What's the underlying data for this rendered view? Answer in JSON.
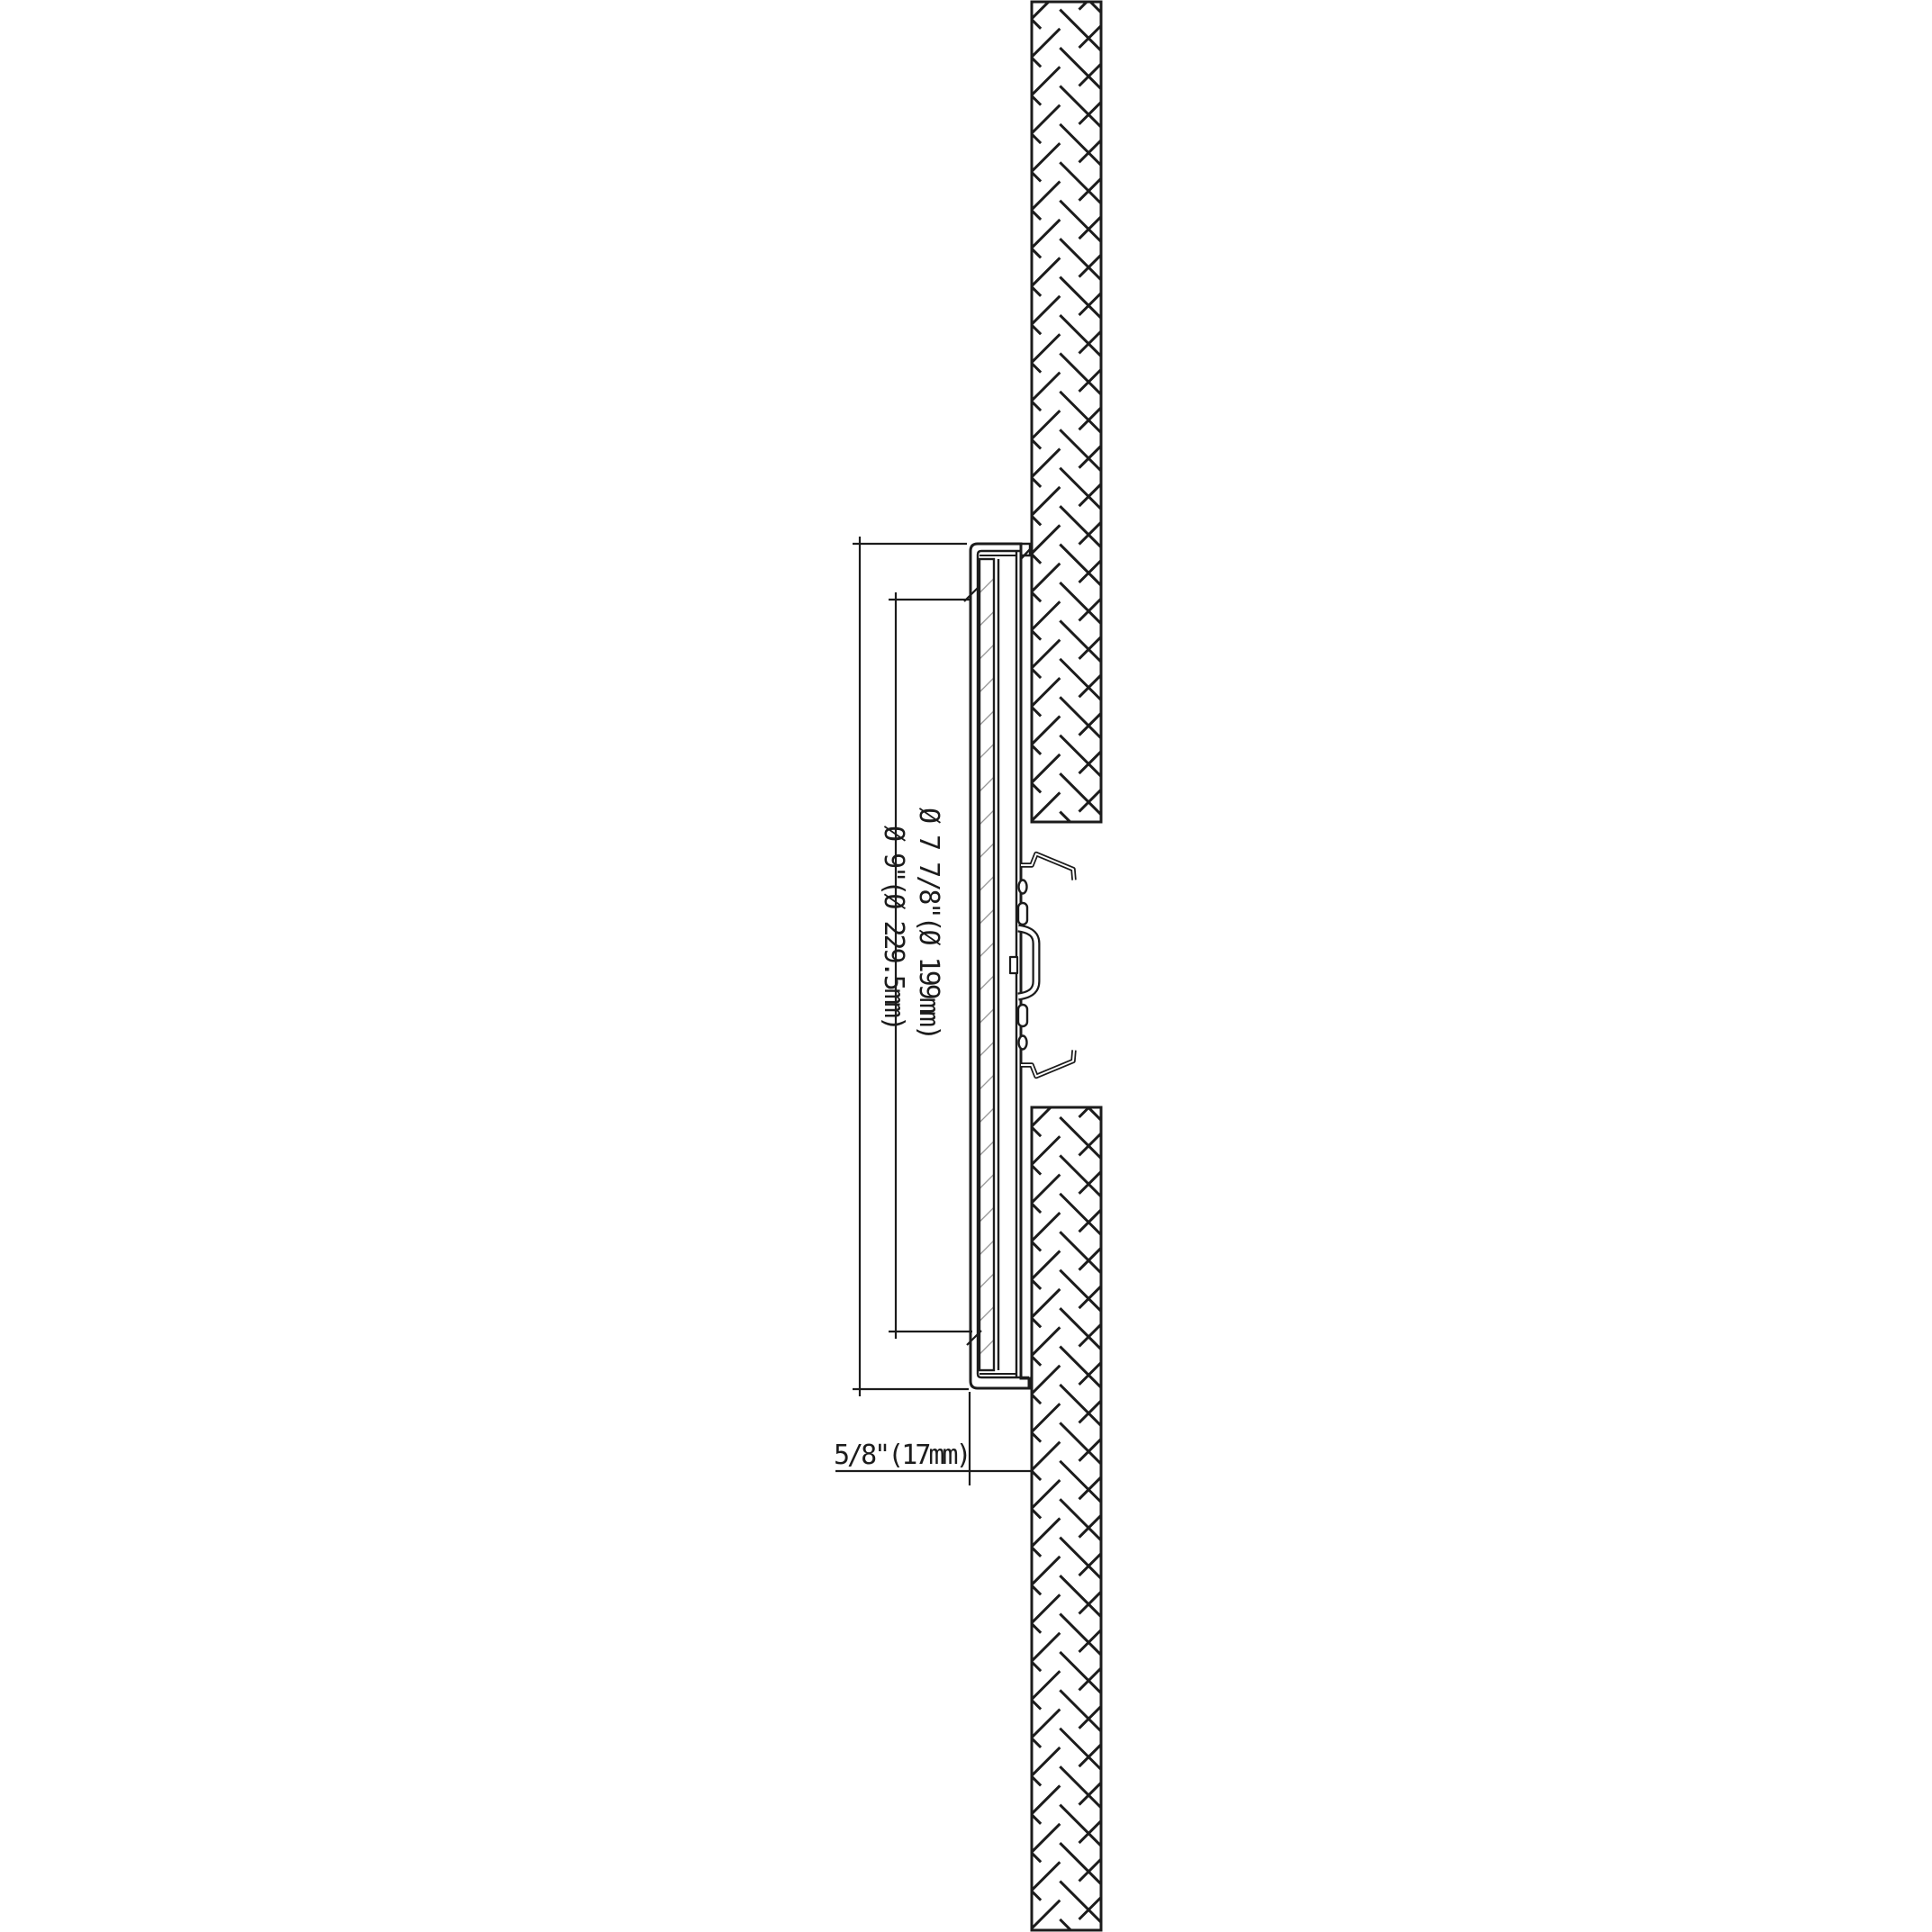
{
  "drawing": {
    "title": "recessed-downlight-side-section",
    "labels": {
      "aperture_diameter": "Ø 7 7/8\"(Ø 199mm)",
      "overall_diameter": "Ø 9\"(Ø 229.5mm)",
      "protrusion_depth": "5/8\"(17mm)"
    },
    "colors": {
      "line": "#1c1c1c",
      "background": "#ffffff",
      "thin_hatch": "#909090"
    }
  }
}
